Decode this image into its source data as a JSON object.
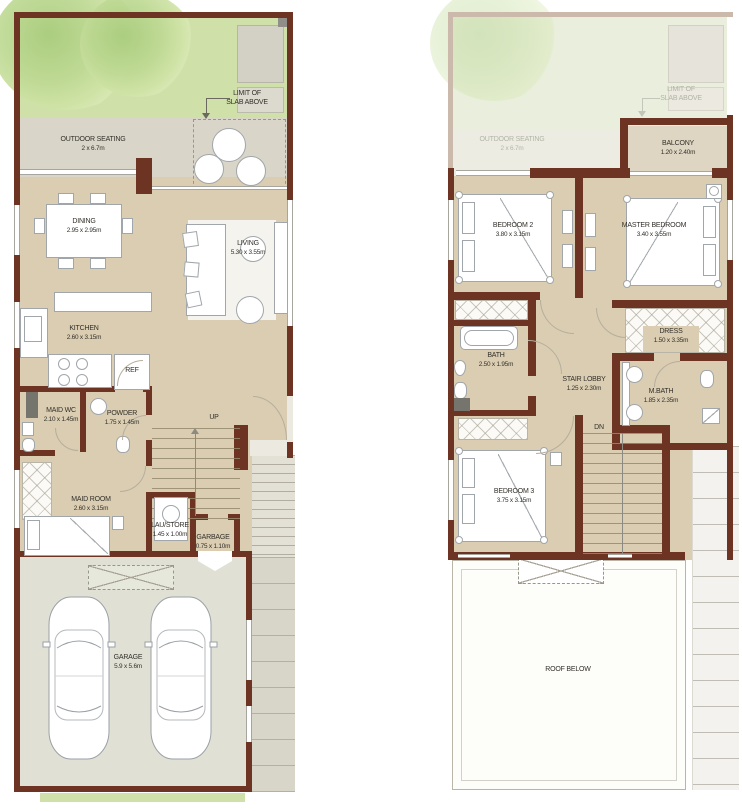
{
  "colors": {
    "wall": "#6e3423",
    "wall_ghost": "#cbb9ab",
    "floor": "#dacdb2",
    "garden": "#cfe0a8",
    "patio": "#d9d5c8",
    "garage_floor": "#e0e1d4",
    "roof": "#fdfdfa"
  },
  "ground": {
    "limit_of_slab": {
      "line1": "LIMIT OF",
      "line2": "SLAB ABOVE"
    },
    "outdoor_seating": {
      "name": "OUTDOOR SEATING",
      "dims": "2 x 6.7m"
    },
    "dining": {
      "name": "DINING",
      "dims": "2.95 x 2.95m"
    },
    "living": {
      "name": "LIVING",
      "dims": "5.30 x 3.55m"
    },
    "kitchen": {
      "name": "KITCHEN",
      "dims": "2.60 x 3.15m"
    },
    "ref": "REF",
    "maid_wc": {
      "name": "MAID WC",
      "dims": "2.10 x 1.45m"
    },
    "powder": {
      "name": "POWDER",
      "dims": "1.75 x 1.45m"
    },
    "up": "UP",
    "maid_room": {
      "name": "MAID ROOM",
      "dims": "2.60 x 3.15m"
    },
    "laundry_store": {
      "name": "LAU/STORE",
      "dims": "1.45 x 1.00m"
    },
    "garbage": {
      "name": "GARBAGE",
      "dims": "0.75 x 1.10m"
    },
    "garage": {
      "name": "GARAGE",
      "dims": "5.9 x 5.6m"
    }
  },
  "first": {
    "limit_of_slab": {
      "line1": "LIMIT OF",
      "line2": "SLAB ABOVE"
    },
    "outdoor_seating": {
      "name": "OUTDOOR SEATING",
      "dims": "2 x 6.7m"
    },
    "balcony": {
      "name": "BALCONY",
      "dims": "1.20 x 2.40m"
    },
    "bedroom_2": {
      "name": "BEDROOM 2",
      "dims": "3.80 x 3.15m"
    },
    "master_bedroom": {
      "name": "MASTER BEDROOM",
      "dims": "3.40 x 3.55m"
    },
    "bath": {
      "name": "BATH",
      "dims": "2.50 x 1.95m"
    },
    "dress": {
      "name": "DRESS",
      "dims": "1.50 x 3.35m"
    },
    "stair_lobby": {
      "name": "STAIR LOBBY",
      "dims": "1.25 x 2.30m"
    },
    "m_bath": {
      "name": "M.BATH",
      "dims": "1.85 x 2.35m"
    },
    "dn": "DN",
    "bedroom_3": {
      "name": "BEDROOM 3",
      "dims": "3.75 x 3.15m"
    },
    "roof_below": "ROOF BELOW"
  }
}
